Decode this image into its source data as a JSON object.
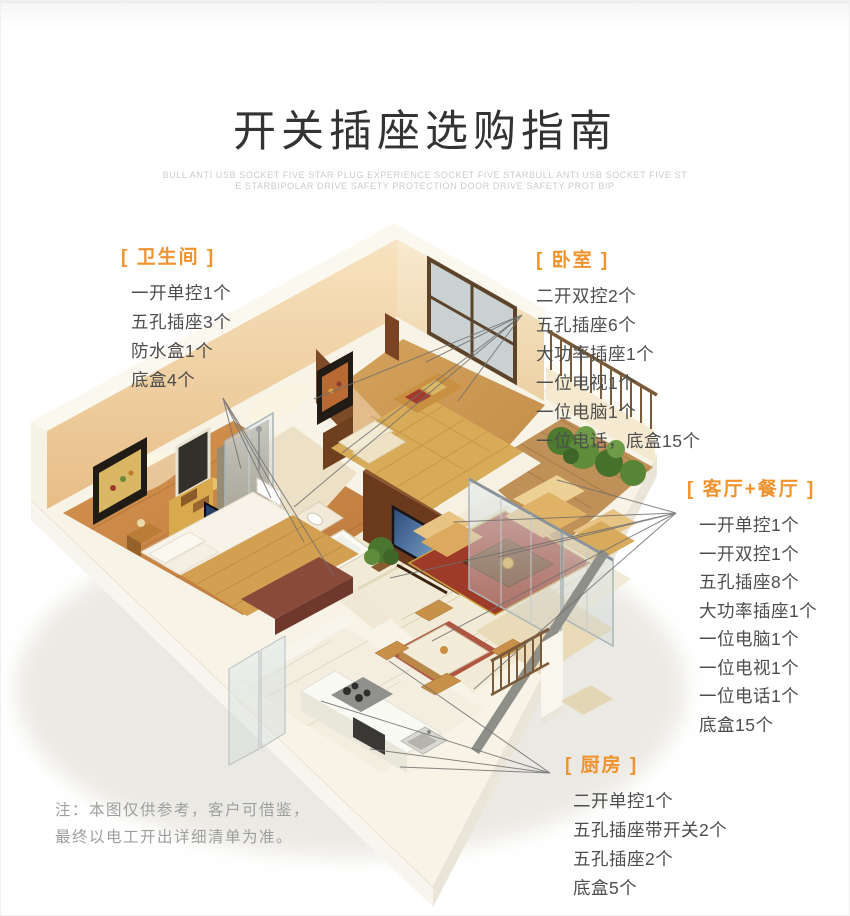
{
  "page": {
    "title": "开关插座选购指南",
    "subtitle_line1": "BULL ANTI USB SOCKET FIVE STAR PLUG EXPERIENCE SOCKET FIVE STARBULL ANTI USB SOCKET FIVE ST",
    "subtitle_line2": "E STARBIPOLAR DRIVE SAFETY PROTECTION DOOR  DRIVE SAFETY PROT BIP",
    "note_line1": "注：本图仅供参考，客户可借鉴，",
    "note_line2": "最终以电工开出详细清单为准。"
  },
  "colors": {
    "accent_orange": "#F0922D",
    "body_text": "#4D4D4D",
    "note_text": "#9E9E9E",
    "subtitle_text": "#CBCBCB"
  },
  "sections": {
    "bathroom": {
      "label": "[ 卫生间 ]",
      "items": [
        "一开单控1个",
        "五孔插座3个",
        "防水盒1个",
        "底盒4个"
      ]
    },
    "bedroom": {
      "label": "[ 卧室 ]",
      "items": [
        "二开双控2个",
        "五孔插座6个",
        "大功率插座1个",
        "一位电视1个",
        "一位电脑1个",
        "一位电话，底盒15个"
      ]
    },
    "living_dining": {
      "label": "[ 客厅+餐厅 ]",
      "items": [
        "一开单控1个",
        "一开双控1个",
        "五孔插座8个",
        "大功率插座1个",
        "一位电脑1个",
        "一位电视1个",
        "一位电话1个",
        "底盒15个"
      ]
    },
    "kitchen": {
      "label": "[ 厨房 ]",
      "items": [
        "二开单控1个",
        "五孔插座带开关2个",
        "五孔插座2个",
        "底盒5个"
      ]
    }
  }
}
